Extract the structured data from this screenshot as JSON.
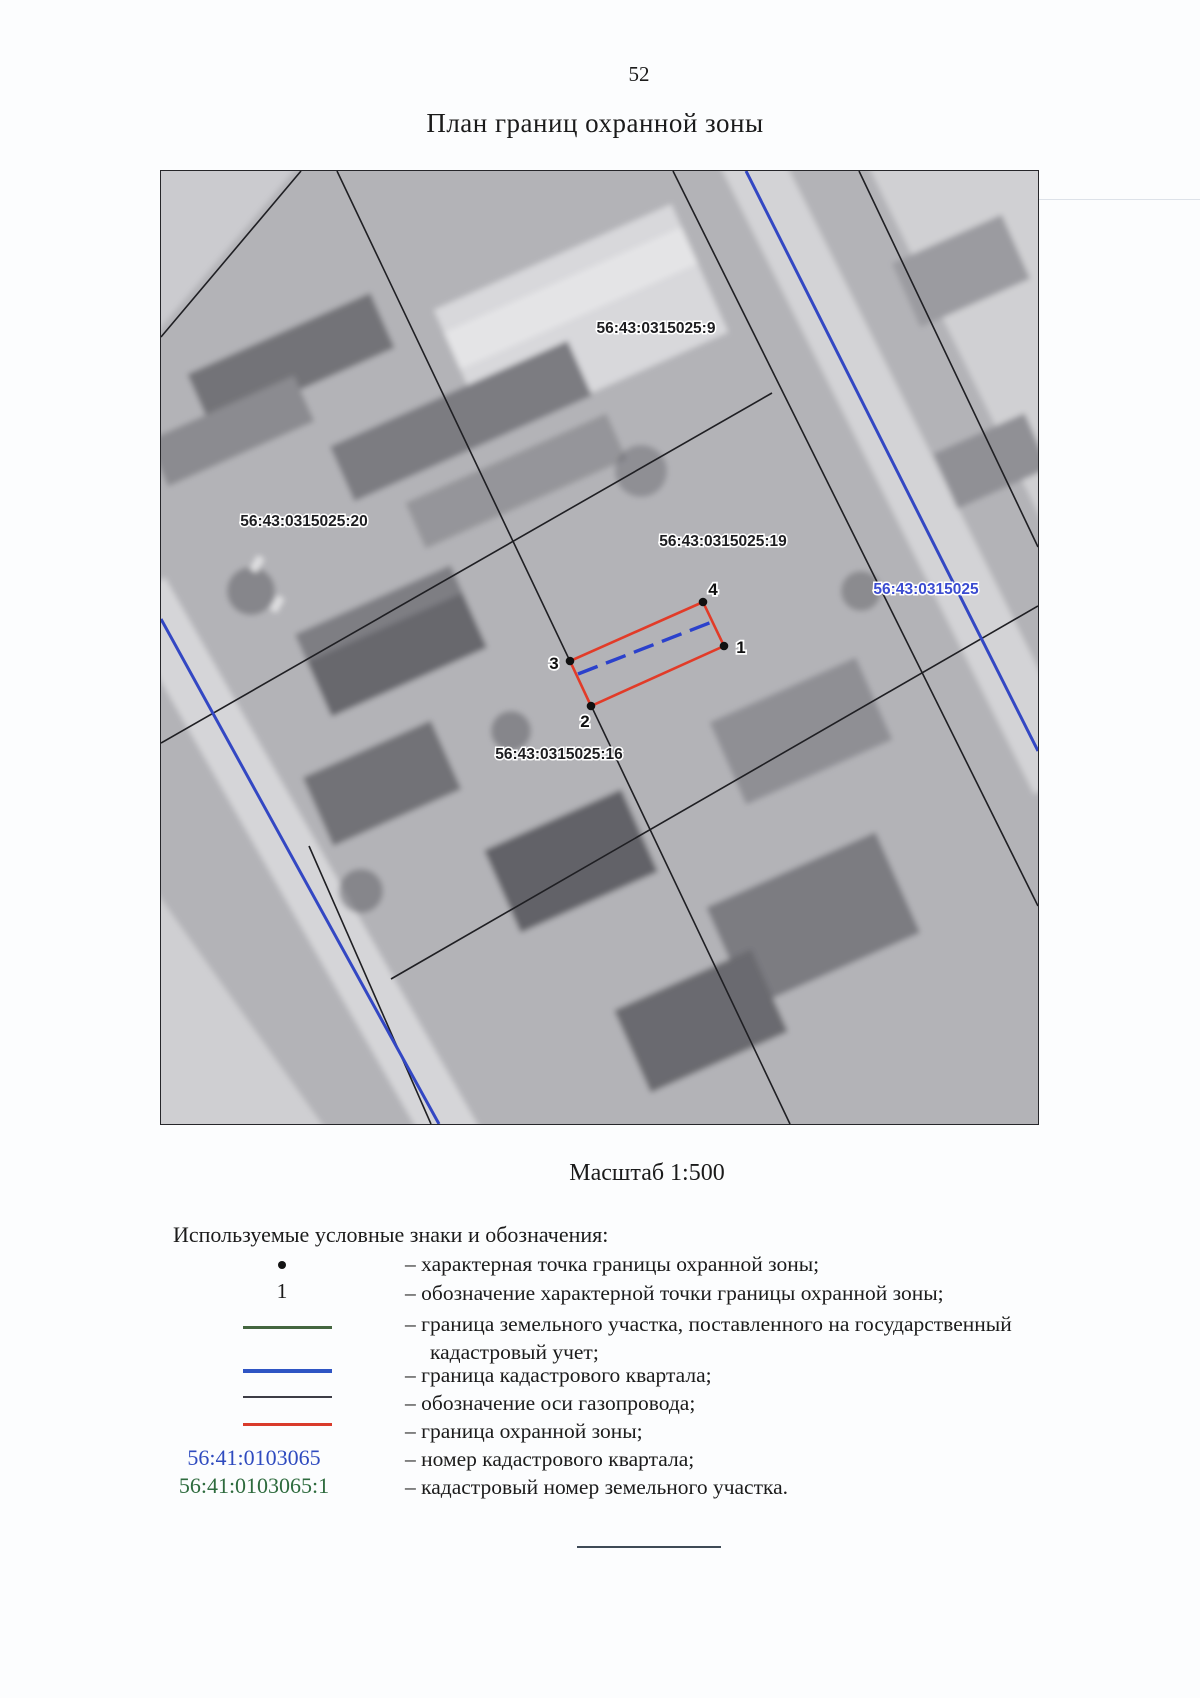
{
  "page": {
    "number": "52",
    "title": "План границ охранной зоны"
  },
  "map": {
    "scale_label": "Масштаб 1:500",
    "parcel_labels": [
      {
        "text": "56:43:0315025:9"
      },
      {
        "text": "56:43:0315025:20"
      },
      {
        "text": "56:43:0315025:19"
      },
      {
        "text": "56:43:0315025"
      },
      {
        "text": "56:43:0315025:16"
      }
    ],
    "boundary_points": [
      {
        "label": "4"
      },
      {
        "label": "1"
      },
      {
        "label": "2"
      },
      {
        "label": "3"
      }
    ]
  },
  "legend": {
    "heading": "Используемые условные знаки и обозначения:",
    "rows": [
      {
        "symbol": "boundary-point-dot",
        "text": "– характерная точка границы охранной зоны;"
      },
      {
        "symbol": "boundary-point-number",
        "symbol_label": "1",
        "text": "– обозначение характерной точки границы охранной зоны;"
      },
      {
        "symbol": "land-parcel-boundary-line",
        "text": "– граница земельного участка, поставленного на государственный кадастровый учет;"
      },
      {
        "symbol": "cadastral-quarter-boundary-line",
        "text": "– граница кадастрового квартала;"
      },
      {
        "symbol": "gas-pipeline-axis-line",
        "text": "– обозначение оси газопровода;"
      },
      {
        "symbol": "protection-zone-boundary-line",
        "text": "– граница охранной зоны;"
      },
      {
        "symbol": "cadastral-quarter-number",
        "symbol_label": "56:41:0103065",
        "text": "– номер кадастрового квартала;"
      },
      {
        "symbol": "parcel-cadastral-number",
        "symbol_label": "56:41:0103065:1",
        "text": "– кадастровый номер земельного участка."
      }
    ]
  },
  "colors": {
    "land_parcel_boundary": "#44663f",
    "cadastral_quarter_boundary": "#2f55c4",
    "gas_pipeline_axis": "#3d3d46",
    "protection_zone_boundary": "#d93b2b",
    "cadastral_quarter_number_text": "#2f4bbf",
    "parcel_cadastral_number_text": "#2e6b3e",
    "map_blue_label": "#3a4bd0"
  }
}
